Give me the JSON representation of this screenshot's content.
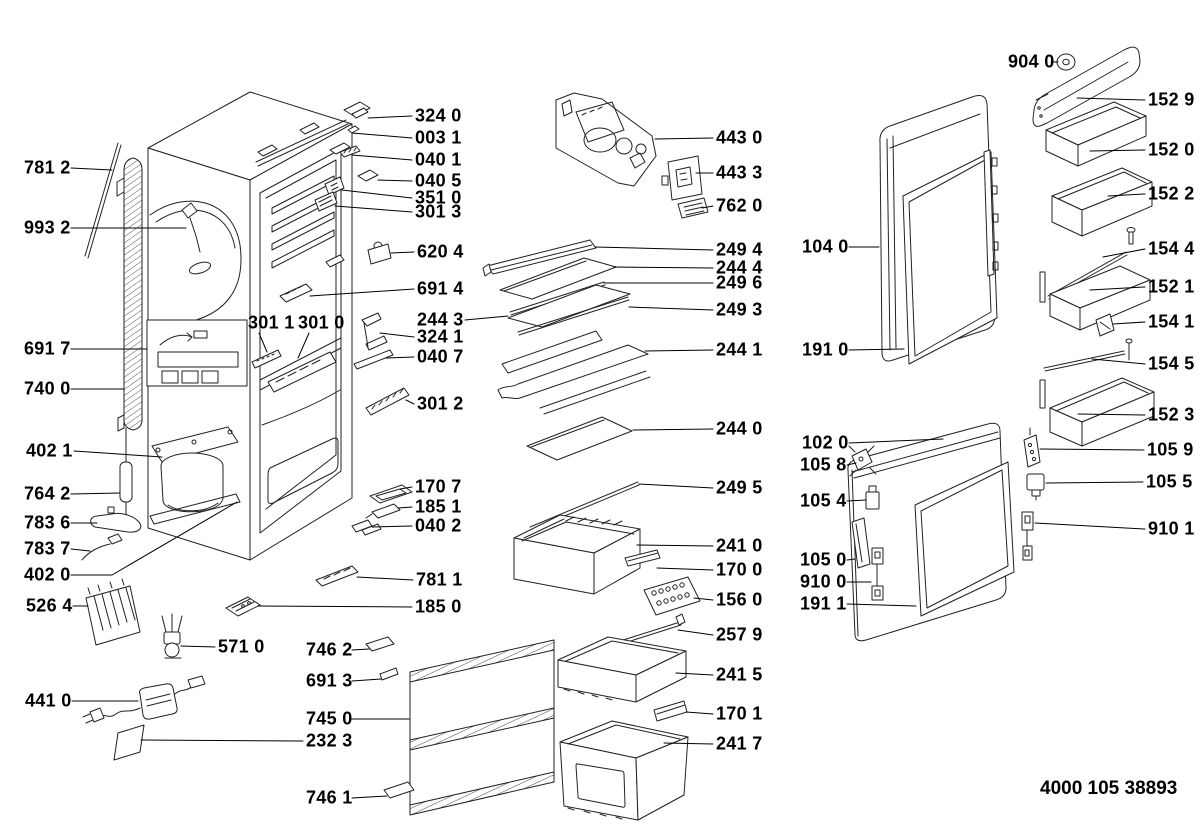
{
  "diagram": {
    "footer_code": "4000 105 38893",
    "background": "#ffffff",
    "ink_color": "#000000",
    "line_color": "#222222",
    "parts": [
      {
        "id": "781-2",
        "label": "781 2",
        "x": 24,
        "y": 168,
        "leader": [
          [
            71,
            168
          ],
          [
            112,
            170
          ]
        ]
      },
      {
        "id": "993-2",
        "label": "993 2",
        "x": 24,
        "y": 228,
        "leader": [
          [
            71,
            228
          ],
          [
            186,
            228
          ]
        ]
      },
      {
        "id": "691-7",
        "label": "691 7",
        "x": 24,
        "y": 349,
        "leader": [
          [
            71,
            349
          ],
          [
            147,
            349
          ]
        ]
      },
      {
        "id": "740-0",
        "label": "740 0",
        "x": 24,
        "y": 389,
        "leader": [
          [
            71,
            389
          ],
          [
            124,
            389
          ]
        ]
      },
      {
        "id": "402-1",
        "label": "402 1",
        "x": 26,
        "y": 451,
        "leader": [
          [
            74,
            451
          ],
          [
            162,
            457
          ]
        ]
      },
      {
        "id": "764-2",
        "label": "764 2",
        "x": 24,
        "y": 494,
        "leader": [
          [
            71,
            494
          ],
          [
            120,
            493
          ]
        ]
      },
      {
        "id": "783-6",
        "label": "783 6",
        "x": 24,
        "y": 523,
        "leader": [
          [
            71,
            523
          ],
          [
            97,
            523
          ]
        ]
      },
      {
        "id": "783-7",
        "label": "783 7",
        "x": 24,
        "y": 549,
        "leader": [
          [
            71,
            549
          ],
          [
            90,
            551
          ]
        ]
      },
      {
        "id": "402-0",
        "label": "402 0",
        "x": 24,
        "y": 575,
        "leader": [
          [
            71,
            575
          ],
          [
            112,
            575
          ],
          [
            237,
            502
          ]
        ]
      },
      {
        "id": "526-4",
        "label": "526 4",
        "x": 26,
        "y": 606,
        "leader": [
          [
            73,
            606
          ],
          [
            88,
            606
          ]
        ]
      },
      {
        "id": "441-0",
        "label": "441 0",
        "x": 25,
        "y": 701,
        "leader": [
          [
            72,
            701
          ],
          [
            138,
            701
          ]
        ]
      },
      {
        "id": "571-0",
        "label": "571 0",
        "x": 218,
        "y": 647,
        "leader": [
          [
            215,
            647
          ],
          [
            181,
            646
          ]
        ]
      },
      {
        "id": "746-2",
        "label": "746 2",
        "x": 306,
        "y": 650,
        "leader": [
          [
            352,
            650
          ],
          [
            369,
            649
          ]
        ]
      },
      {
        "id": "691-3",
        "label": "691 3",
        "x": 306,
        "y": 681,
        "leader": [
          [
            352,
            681
          ],
          [
            381,
            679
          ]
        ]
      },
      {
        "id": "745-0",
        "label": "745 0",
        "x": 306,
        "y": 719,
        "leader": [
          [
            352,
            719
          ],
          [
            409,
            719
          ]
        ]
      },
      {
        "id": "232-3",
        "label": "232 3",
        "x": 306,
        "y": 741,
        "leader": [
          [
            303,
            741
          ],
          [
            141,
            740
          ]
        ]
      },
      {
        "id": "746-1",
        "label": "746 1",
        "x": 306,
        "y": 798,
        "leader": [
          [
            352,
            798
          ],
          [
            387,
            796
          ]
        ]
      },
      {
        "id": "324-0",
        "label": "324 0",
        "x": 415,
        "y": 116,
        "leader": [
          [
            412,
            116
          ],
          [
            368,
            118
          ]
        ]
      },
      {
        "id": "003-1",
        "label": "003 1",
        "x": 415,
        "y": 138,
        "leader": [
          [
            412,
            138
          ],
          [
            352,
            133
          ]
        ]
      },
      {
        "id": "040-1",
        "label": "040 1",
        "x": 415,
        "y": 160,
        "leader": [
          [
            412,
            160
          ],
          [
            352,
            155
          ]
        ]
      },
      {
        "id": "040-5",
        "label": "040 5",
        "x": 415,
        "y": 181,
        "leader": [
          [
            412,
            181
          ],
          [
            378,
            180
          ]
        ]
      },
      {
        "id": "351-0",
        "label": "351 0",
        "x": 415,
        "y": 198,
        "leader": [
          [
            412,
            198
          ],
          [
            342,
            190
          ]
        ]
      },
      {
        "id": "301-3",
        "label": "301 3",
        "x": 415,
        "y": 212,
        "leader": [
          [
            412,
            212
          ],
          [
            335,
            206
          ]
        ]
      },
      {
        "id": "620-4",
        "label": "620 4",
        "x": 417,
        "y": 252,
        "leader": [
          [
            414,
            252
          ],
          [
            391,
            253
          ]
        ]
      },
      {
        "id": "691-4",
        "label": "691 4",
        "x": 417,
        "y": 289,
        "leader": [
          [
            414,
            289
          ],
          [
            310,
            296
          ]
        ]
      },
      {
        "id": "244-3",
        "label": "244 3",
        "x": 417,
        "y": 320,
        "leader": [
          [
            465,
            320
          ],
          [
            508,
            316
          ]
        ]
      },
      {
        "id": "324-1",
        "label": "324 1",
        "x": 417,
        "y": 337,
        "leader": [
          [
            414,
            337
          ],
          [
            380,
            333
          ]
        ]
      },
      {
        "id": "040-7",
        "label": "040 7",
        "x": 417,
        "y": 357,
        "leader": [
          [
            414,
            357
          ],
          [
            386,
            358
          ]
        ]
      },
      {
        "id": "301-2",
        "label": "301 2",
        "x": 417,
        "y": 404,
        "leader": [
          [
            414,
            404
          ],
          [
            406,
            400
          ]
        ]
      },
      {
        "id": "301-1",
        "label": "301 1",
        "x": 248,
        "y": 323,
        "leader": [
          [
            259,
            333
          ],
          [
            267,
            352
          ]
        ]
      },
      {
        "id": "301-0",
        "label": "301 0",
        "x": 298,
        "y": 323,
        "leader": [
          [
            309,
            333
          ],
          [
            298,
            358
          ]
        ]
      },
      {
        "id": "170-7",
        "label": "170 7",
        "x": 415,
        "y": 487,
        "leader": [
          [
            412,
            487
          ],
          [
            400,
            489
          ]
        ]
      },
      {
        "id": "185-1",
        "label": "185 1",
        "x": 415,
        "y": 507,
        "leader": [
          [
            412,
            507
          ],
          [
            398,
            508
          ]
        ]
      },
      {
        "id": "040-2",
        "label": "040 2",
        "x": 415,
        "y": 526,
        "leader": [
          [
            412,
            526
          ],
          [
            372,
            527
          ]
        ]
      },
      {
        "id": "781-1",
        "label": "781 1",
        "x": 416,
        "y": 580,
        "leader": [
          [
            413,
            580
          ],
          [
            357,
            577
          ]
        ]
      },
      {
        "id": "185-0",
        "label": "185 0",
        "x": 415,
        "y": 607,
        "leader": [
          [
            412,
            607
          ],
          [
            258,
            606
          ]
        ]
      },
      {
        "id": "443-0",
        "label": "443 0",
        "x": 716,
        "y": 138,
        "leader": [
          [
            713,
            138
          ],
          [
            655,
            139
          ]
        ]
      },
      {
        "id": "443-3",
        "label": "443 3",
        "x": 716,
        "y": 173,
        "leader": [
          [
            713,
            173
          ],
          [
            696,
            173
          ]
        ]
      },
      {
        "id": "762-0",
        "label": "762 0",
        "x": 716,
        "y": 206,
        "leader": [
          [
            713,
            206
          ],
          [
            702,
            208
          ]
        ]
      },
      {
        "id": "249-4",
        "label": "249 4",
        "x": 716,
        "y": 250,
        "leader": [
          [
            713,
            250
          ],
          [
            595,
            247
          ]
        ]
      },
      {
        "id": "244-4",
        "label": "244 4",
        "x": 716,
        "y": 268,
        "leader": [
          [
            713,
            268
          ],
          [
            614,
            267
          ]
        ]
      },
      {
        "id": "249-6",
        "label": "249 6",
        "x": 716,
        "y": 283,
        "leader": [
          [
            713,
            283
          ],
          [
            604,
            283
          ]
        ]
      },
      {
        "id": "249-3",
        "label": "249 3",
        "x": 716,
        "y": 310,
        "leader": [
          [
            713,
            310
          ],
          [
            629,
            307
          ]
        ]
      },
      {
        "id": "244-1",
        "label": "244 1",
        "x": 716,
        "y": 350,
        "leader": [
          [
            713,
            350
          ],
          [
            645,
            351
          ]
        ]
      },
      {
        "id": "244-0",
        "label": "244 0",
        "x": 716,
        "y": 429,
        "leader": [
          [
            713,
            429
          ],
          [
            633,
            430
          ]
        ]
      },
      {
        "id": "249-5",
        "label": "249 5",
        "x": 716,
        "y": 488,
        "leader": [
          [
            713,
            488
          ],
          [
            639,
            484
          ]
        ]
      },
      {
        "id": "241-0",
        "label": "241 0",
        "x": 716,
        "y": 546,
        "leader": [
          [
            713,
            546
          ],
          [
            637,
            545
          ]
        ]
      },
      {
        "id": "170-0",
        "label": "170 0",
        "x": 716,
        "y": 570,
        "leader": [
          [
            713,
            570
          ],
          [
            657,
            568
          ]
        ]
      },
      {
        "id": "156-0",
        "label": "156 0",
        "x": 716,
        "y": 600,
        "leader": [
          [
            713,
            600
          ],
          [
            694,
            598
          ]
        ]
      },
      {
        "id": "257-9",
        "label": "257 9",
        "x": 716,
        "y": 635,
        "leader": [
          [
            713,
            635
          ],
          [
            678,
            630
          ]
        ]
      },
      {
        "id": "241-5",
        "label": "241 5",
        "x": 716,
        "y": 675,
        "leader": [
          [
            713,
            675
          ],
          [
            676,
            673
          ]
        ]
      },
      {
        "id": "170-1",
        "label": "170 1",
        "x": 716,
        "y": 714,
        "leader": [
          [
            713,
            714
          ],
          [
            686,
            712
          ]
        ]
      },
      {
        "id": "241-7",
        "label": "241 7",
        "x": 716,
        "y": 744,
        "leader": [
          [
            713,
            744
          ],
          [
            664,
            743
          ]
        ]
      },
      {
        "id": "904-0",
        "label": "904 0",
        "x": 1008,
        "y": 62,
        "leader": [
          [
            1051,
            62
          ],
          [
            1058,
            62
          ]
        ]
      },
      {
        "id": "152-9",
        "label": "152 9",
        "x": 1148,
        "y": 100,
        "leader": [
          [
            1145,
            100
          ],
          [
            1077,
            98
          ]
        ]
      },
      {
        "id": "152-0",
        "label": "152 0",
        "x": 1148,
        "y": 150,
        "leader": [
          [
            1145,
            150
          ],
          [
            1090,
            151
          ]
        ]
      },
      {
        "id": "152-2",
        "label": "152 2",
        "x": 1148,
        "y": 194,
        "leader": [
          [
            1145,
            194
          ],
          [
            1108,
            196
          ]
        ]
      },
      {
        "id": "104-0",
        "label": "104 0",
        "x": 802,
        "y": 247,
        "leader": [
          [
            849,
            247
          ],
          [
            879,
            247
          ]
        ]
      },
      {
        "id": "154-4",
        "label": "154 4",
        "x": 1148,
        "y": 249,
        "leader": [
          [
            1145,
            249
          ],
          [
            1103,
            257
          ]
        ]
      },
      {
        "id": "152-1",
        "label": "152 1",
        "x": 1148,
        "y": 287,
        "leader": [
          [
            1145,
            287
          ],
          [
            1090,
            290
          ]
        ]
      },
      {
        "id": "154-1",
        "label": "154 1",
        "x": 1148,
        "y": 322,
        "leader": [
          [
            1145,
            322
          ],
          [
            1113,
            324
          ]
        ]
      },
      {
        "id": "191-0",
        "label": "191 0",
        "x": 802,
        "y": 350,
        "leader": [
          [
            849,
            350
          ],
          [
            904,
            349
          ]
        ]
      },
      {
        "id": "154-5",
        "label": "154 5",
        "x": 1148,
        "y": 364,
        "leader": [
          [
            1145,
            364
          ],
          [
            1092,
            359
          ]
        ]
      },
      {
        "id": "152-3",
        "label": "152 3",
        "x": 1148,
        "y": 415,
        "leader": [
          [
            1145,
            415
          ],
          [
            1078,
            414
          ]
        ]
      },
      {
        "id": "105-9",
        "label": "105 9",
        "x": 1147,
        "y": 450,
        "leader": [
          [
            1144,
            450
          ],
          [
            1040,
            449
          ]
        ]
      },
      {
        "id": "102-0",
        "label": "102 0",
        "x": 802,
        "y": 443,
        "leader": [
          [
            849,
            443
          ],
          [
            943,
            439
          ]
        ]
      },
      {
        "id": "105-8",
        "label": "105 8",
        "x": 800,
        "y": 465,
        "leader": [
          [
            847,
            465
          ],
          [
            856,
            463
          ]
        ]
      },
      {
        "id": "105-5",
        "label": "105 5",
        "x": 1146,
        "y": 482,
        "leader": [
          [
            1143,
            482
          ],
          [
            1046,
            483
          ]
        ]
      },
      {
        "id": "105-4",
        "label": "105 4",
        "x": 800,
        "y": 501,
        "leader": [
          [
            847,
            501
          ],
          [
            866,
            500
          ]
        ]
      },
      {
        "id": "910-1",
        "label": "910 1",
        "x": 1148,
        "y": 529,
        "leader": [
          [
            1145,
            529
          ],
          [
            1035,
            523
          ]
        ]
      },
      {
        "id": "105-0",
        "label": "105 0",
        "x": 800,
        "y": 560,
        "leader": [
          [
            847,
            560
          ],
          [
            855,
            559
          ]
        ]
      },
      {
        "id": "910-0",
        "label": "910 0",
        "x": 800,
        "y": 582,
        "leader": [
          [
            847,
            582
          ],
          [
            871,
            582
          ]
        ]
      },
      {
        "id": "191-1",
        "label": "191 1",
        "x": 800,
        "y": 604,
        "leader": [
          [
            847,
            604
          ],
          [
            916,
            606
          ]
        ]
      }
    ]
  }
}
